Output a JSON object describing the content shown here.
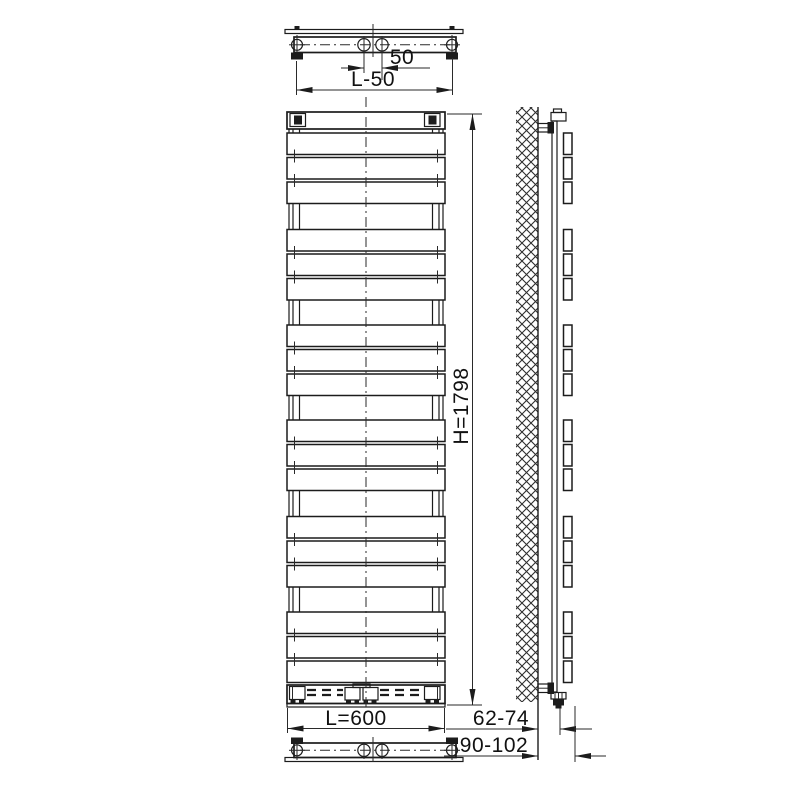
{
  "dimensions": {
    "pipe_spacing_top": "50",
    "mounting_span_top": "L-50",
    "height": "H=1798",
    "width": "L=600",
    "wall_to_pipe_axis": "62-74",
    "wall_to_front_face": "90-102"
  },
  "radiator": {
    "front": {
      "x": 287,
      "w": 158
    },
    "side": {
      "x": 563.5,
      "w": 8.5
    },
    "panel_h": 21.5,
    "panel_gap": 3,
    "panels_per_group": 3,
    "panel_count": 18,
    "groups": [
      {
        "y": 133
      },
      {
        "y": 229.5
      },
      {
        "y": 325
      },
      {
        "y": 420
      },
      {
        "y": 516.5
      },
      {
        "y": 612
      }
    ],
    "collector_gaps": [
      [
        129,
        133
      ],
      [
        203.5,
        229.5
      ],
      [
        300,
        325
      ],
      [
        395.5,
        420
      ],
      [
        490.5,
        516.5
      ],
      [
        587,
        612
      ]
    ],
    "tick_x": [
      294.5,
      437.5
    ],
    "tube_x": [
      289,
      293,
      299.5,
      432.5,
      439,
      443
    ]
  }
}
